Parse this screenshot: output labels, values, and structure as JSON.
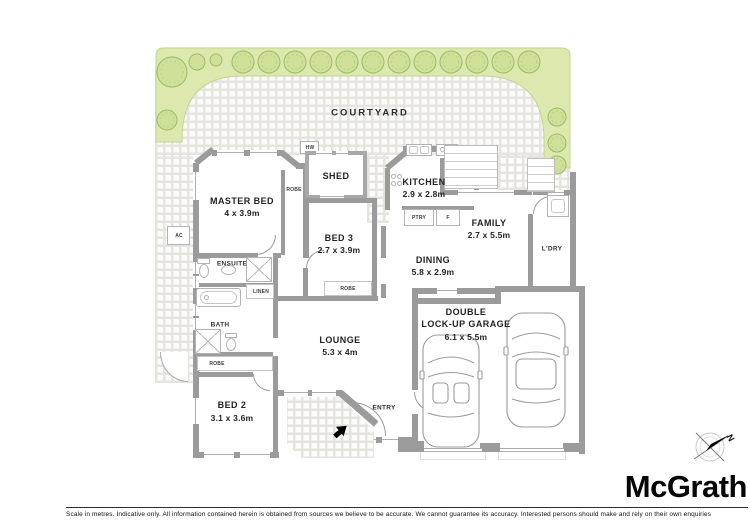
{
  "courtyard": {
    "label": "COURTYARD"
  },
  "rooms": {
    "master": {
      "label": "MASTER BED",
      "dims": "4 x 3.9m"
    },
    "bed3": {
      "label": "BED 3",
      "dims": "2.7 x 3.9m"
    },
    "bed2": {
      "label": "BED 2",
      "dims": "3.1 x 3.6m"
    },
    "lounge": {
      "label": "LOUNGE",
      "dims": "5.3 x 4m"
    },
    "kitchen": {
      "label": "KITCHEN",
      "dims": "2.9 x 2.8m"
    },
    "family": {
      "label": "FAMILY",
      "dims": "2.7 x 5.5m"
    },
    "dining": {
      "label": "DINING",
      "dims": "5.8 x 2.9m"
    },
    "garage": {
      "label_line1": "DOUBLE",
      "label_line2": "LOCK-UP GARAGE",
      "dims": "6.1 x 5.5m"
    },
    "shed": {
      "label": "SHED"
    },
    "ensuite": {
      "label": "ENSUITE"
    },
    "bath": {
      "label": "BATH"
    },
    "laundry": {
      "label": "L'DRY"
    },
    "entry": {
      "label": "ENTRY"
    }
  },
  "labels": {
    "robe": "ROBE",
    "linen": "LINEN",
    "hw": "HW",
    "ac": "AC",
    "pantry": "PTRY",
    "fridge": "F"
  },
  "compass": {
    "north": "N"
  },
  "footer": {
    "disclaimer": "Scale in metres. Indicative only. All information contained herein is obtained from sources we believe to be accurate. We cannot guarantee its accuracy. Interested persons should make and rely on their own enquiries",
    "brand": "McGrath"
  },
  "colors": {
    "wall": "#9b9b9b",
    "hedge_fill": "#dce8ad",
    "tree_fill": "#cfe099",
    "tree_stroke": "#9cba6b",
    "paving_grout": "#e5e4df"
  }
}
